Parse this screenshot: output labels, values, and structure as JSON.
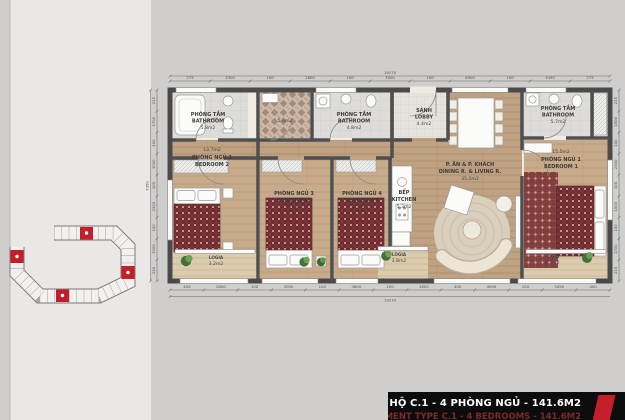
{
  "title_bar": {
    "line1": "MẶT BẰNG CĂN HỘ C.1 - 4 PHÒNG NGỦ - 141.6M2",
    "line2": "APARTMENT TYPE C.1 - 4 BEDROOMS - 141.6M2",
    "accent_color": "#c41e2a"
  },
  "key_plan": {
    "highlight_color": "#c41e2a",
    "unit_fill": "#f2f1ee",
    "outline": "#7a7a7a"
  },
  "palette": {
    "wall": "#4a4a4a",
    "wood_floor": "#bfa283",
    "loggia_floor": "#dcccae",
    "bedding_red": "#6f2b2f",
    "plant_green": "#44713a"
  },
  "plan": {
    "rooms": {
      "bathroom1": {
        "name_vi": "PHÒNG TẮM",
        "name_en": "BATHROOM",
        "area": "5.8m2"
      },
      "tile_hall": {
        "area": "5.9m2"
      },
      "bathroom2": {
        "name_vi": "PHÒNG TẮM",
        "name_en": "BATHROOM",
        "area": "4.8m2"
      },
      "lobby": {
        "name_vi": "SẢNH",
        "name_en": "LOBBY",
        "area": "4.4m2"
      },
      "bathroom3": {
        "name_vi": "PHÒNG TẮM",
        "name_en": "BATHROOM",
        "area": "5.7m2"
      },
      "bedroom2": {
        "name_vi": "PHÒNG NGỦ 2",
        "name_en": "BEDROOM 2",
        "area": "13.7m2"
      },
      "bedroom3": {
        "name_vi": "PHÒNG NGỦ 3",
        "name_en": "BEDROOM 3",
        "area": "13.7m2"
      },
      "bedroom4": {
        "name_vi": "PHÒNG NGỦ 4",
        "name_en": "BEDROOM 4",
        "area": "13.7m2"
      },
      "bedroom1": {
        "name_vi": "PHÒNG NGỦ 1",
        "name_en": "BEDROOM 1",
        "area": "15.5m2"
      },
      "living": {
        "name_vi": "P. ĂN & P. KHÁCH",
        "name_en": "DINING R. & LIVING R.",
        "area": "35.2m2"
      },
      "kitchen": {
        "name_vi": "BẾP",
        "name_en": "KITCHEN",
        "area": "5.3m2"
      },
      "loggia1": {
        "name": "LOGIA",
        "area": "3.2m2"
      },
      "loggia2": {
        "name": "LOGIA",
        "area": "3.8m2"
      },
      "loggia3": {
        "name": "LOGIA",
        "area": "4.2m2"
      }
    }
  },
  "dimensions": {
    "top": {
      "total": "19270",
      "segments": [
        "275",
        "3300",
        "100",
        "2800",
        "100",
        "3000",
        "100",
        "6900",
        "100",
        "3450",
        "275"
      ]
    },
    "bottom": {
      "total": "19270",
      "segments": [
        "400",
        "2800",
        "100",
        "3000",
        "100",
        "3600",
        "100",
        "1600",
        "400",
        "4940",
        "100",
        "3450",
        "400"
      ]
    },
    "left": {
      "total": "7350",
      "segments": [
        "215",
        "1700",
        "100",
        "1000",
        "100",
        "2300",
        "100",
        "1500",
        "215"
      ]
    },
    "right": {
      "segments": [
        "215",
        "1500",
        "100",
        "2300",
        "100",
        "1000",
        "100",
        "1700",
        "215"
      ]
    }
  }
}
